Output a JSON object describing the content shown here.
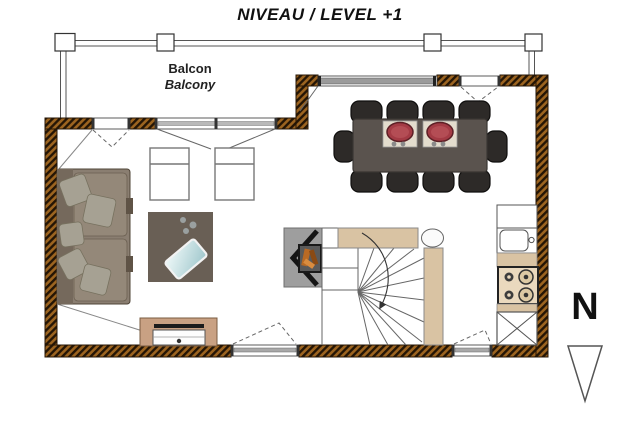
{
  "title": "NIVEAU / LEVEL +1",
  "balcony": {
    "label_fr": "Balcon",
    "label_en": "Balcony"
  },
  "compass": {
    "north_label": "N"
  },
  "colors": {
    "wall_hatch_dark": "#241505",
    "wall_hatch_orange": "#9c6420",
    "stair_wall_tan": "#d9c3a3",
    "dining_table": "#5a534e",
    "chair_dark": "#2d2a28",
    "plate_red": "#a43b45",
    "placemat_beige": "#e3dccd",
    "sofa_taupe": "#8a7e71",
    "pillow_gray": "#a6a193",
    "rug_brown": "#695f55",
    "tray_blue": "#cfe6e8",
    "tv_unit_tan": "#c9a183",
    "window_glass_gray": "#9a9a9a",
    "fireplace_gray": "#9e9e9e",
    "fire_log_orange": "#b96a24"
  }
}
